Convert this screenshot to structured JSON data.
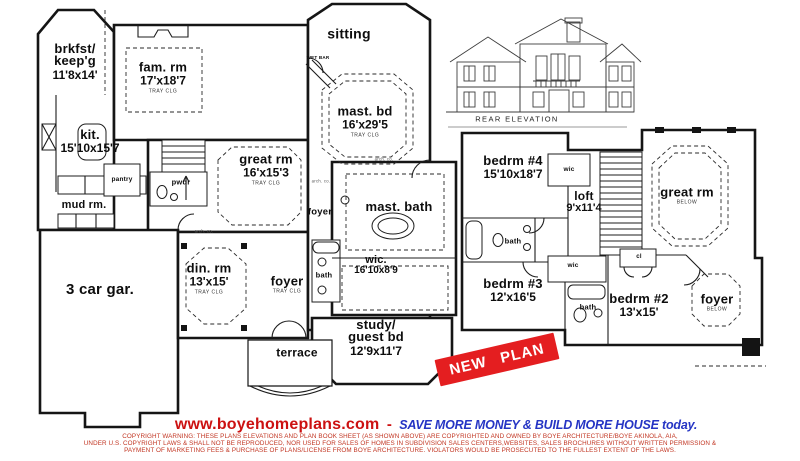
{
  "stamp": {
    "label": "NEW PLAN",
    "bg": "#e41e20",
    "fg": "#ffffff"
  },
  "elevation": {
    "caption": "REAR ELEVATION"
  },
  "annotations": {
    "arch": "arch. co."
  },
  "floor1": {
    "rooms": [
      {
        "name": "brkfst/\nkeep'g",
        "dims": "11'8x14'"
      },
      {
        "name": "fam. rm",
        "dims": "17'x18'7",
        "note": "TRAY CLG"
      },
      {
        "name": "kit.",
        "dims": "15'10x15'7"
      },
      {
        "name": "mud rm."
      },
      {
        "name": "great rm",
        "dims": "16'x15'3",
        "note": "TRAY CLG"
      },
      {
        "name": "sitting"
      },
      {
        "name": "mast. bd",
        "dims": "16'x29'5",
        "note": "TRAY CLG"
      },
      {
        "name": "mast. bath"
      },
      {
        "name": "wic.",
        "dims": "16'10x8'9"
      },
      {
        "name": "foyer"
      },
      {
        "name": "bath"
      },
      {
        "name": "foyer",
        "note": "TRAY CLG"
      },
      {
        "name": "din. rm",
        "dims": "13'x15'",
        "note": "TRAY CLG"
      },
      {
        "name": "3 car gar."
      },
      {
        "name": "terrace"
      },
      {
        "name": "study/\nguest bd",
        "dims": "12'9x11'7"
      },
      {
        "name": "pantry"
      },
      {
        "name": "pwdr"
      },
      {
        "name": "WET BAR"
      }
    ]
  },
  "floor2": {
    "rooms": [
      {
        "name": "bedrm #4",
        "dims": "15'10x18'7"
      },
      {
        "name": "wic"
      },
      {
        "name": "loft",
        "dims": "9'x11'4"
      },
      {
        "name": "great rm",
        "note": "BELOW"
      },
      {
        "name": "bath"
      },
      {
        "name": "bedrm #3",
        "dims": "12'x16'5"
      },
      {
        "name": "wic"
      },
      {
        "name": "bath"
      },
      {
        "name": "cl"
      },
      {
        "name": "bedrm #2",
        "dims": "13'x15'"
      },
      {
        "name": "foyer",
        "note": "BELOW"
      }
    ]
  },
  "footer": {
    "website": "www.boyehomeplans.com",
    "separator": "-",
    "tagline": "SAVE MORE MONEY & BUILD MORE HOUSE today.",
    "website_color": "#cc1111",
    "tagline_color": "#2534c4",
    "copyright_lines": [
      "COPYRIGHT WARNING: THESE PLANS ELEVATIONS AND PLAN BOOK SHEET (AS SHOWN ABOVE) ARE COPYRIGHTED AND OWNED BY BOYE ARCHITECTURE/BOYE AKINOLA, AIA,",
      "UNDER U.S. COPYRIGHT LAWS & SHALL NOT BE REPRODUCED, NOR USED FOR SALES OF HOMES IN SUBDIVISION SALES CENTERS,WEBSITES, SALES BROCHURES WITHOUT WRITTEN PERMISSION &",
      "PAYMENT OF MARKETING FEES & PURCHASE OF  PLANS/LICENSE FROM  BOYE ARCHITECTURE. VIOLATORS  WOULD BE PROSECUTED TO THE FULLEST EXTENT OF THE LAWS."
    ]
  }
}
